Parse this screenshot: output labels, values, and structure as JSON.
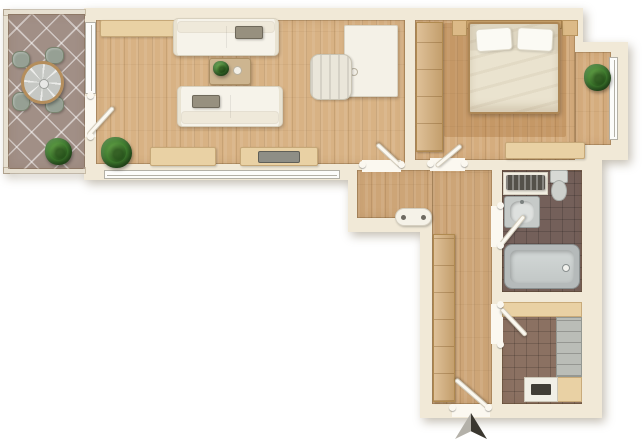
{
  "plan": {
    "width": 642,
    "height": 439,
    "background": "#ffffff"
  },
  "palette": {
    "wall": "#f1e9d7",
    "door_white": "#fbf8f0",
    "counter": "#e9d1a4",
    "wardrobe": "#d4ac76",
    "sofa": "#f6f3ea",
    "bed_duvet": "#eae3cf",
    "arrow_light": "#b4b1a9",
    "arrow_dark": "#3a372f"
  },
  "slabs": [
    {
      "name": "walls-main-block",
      "x": 84,
      "y": 8,
      "w": 499,
      "h": 172
    },
    {
      "name": "walls-bedroom-bay",
      "x": 583,
      "y": 42,
      "w": 45,
      "h": 118
    },
    {
      "name": "walls-hall-bath-block",
      "x": 348,
      "y": 160,
      "w": 254,
      "h": 72
    },
    {
      "name": "walls-lower-block",
      "x": 420,
      "y": 232,
      "w": 182,
      "h": 186
    }
  ],
  "railings": [
    {
      "name": "balcony-railing-left",
      "x": 4,
      "y": 10,
      "w": 5,
      "h": 163
    },
    {
      "name": "balcony-railing-top",
      "x": 4,
      "y": 10,
      "w": 81,
      "h": 5
    },
    {
      "name": "balcony-railing-bottom",
      "x": 4,
      "y": 168,
      "w": 81,
      "h": 5
    }
  ],
  "floors": [
    {
      "name": "balcony-floor",
      "kind": "tile-balcony",
      "color": "#a18f86",
      "x": 8,
      "y": 14,
      "w": 77,
      "h": 155
    },
    {
      "name": "living-room-floor",
      "kind": "wood",
      "color": "#d8b284",
      "x": 96,
      "y": 20,
      "w": 309,
      "h": 144
    },
    {
      "name": "bedroom-floor",
      "kind": "wood",
      "color": "#d5ad7e",
      "x": 415,
      "y": 20,
      "w": 160,
      "h": 140
    },
    {
      "name": "bedroom-bay-floor",
      "kind": "wood",
      "color": "#d5ad7e",
      "x": 575,
      "y": 52,
      "w": 36,
      "h": 93
    },
    {
      "name": "bedroom-rug",
      "kind": "rug",
      "color": "rgba(150,92,36,0.26)",
      "x": 444,
      "y": 23,
      "w": 122,
      "h": 114
    },
    {
      "name": "hall-floor-upper",
      "kind": "wood",
      "color": "#cda577",
      "x": 357,
      "y": 170,
      "w": 135,
      "h": 48
    },
    {
      "name": "hall-floor-lower",
      "kind": "wood",
      "color": "#cda577",
      "x": 432,
      "y": 170,
      "w": 60,
      "h": 234
    },
    {
      "name": "bathroom-floor",
      "kind": "tile-bath",
      "color": "#74605a",
      "x": 502,
      "y": 170,
      "w": 80,
      "h": 122
    },
    {
      "name": "kitchen-floor",
      "kind": "tile-kitchen",
      "color": "#8b7162",
      "x": 502,
      "y": 302,
      "w": 80,
      "h": 102
    }
  ],
  "gaps": [
    {
      "name": "balcony-door-opening",
      "x": 85,
      "y": 96,
      "w": 11,
      "h": 41
    },
    {
      "name": "living-door-threshold",
      "x": 362,
      "y": 160,
      "w": 39,
      "h": 12
    },
    {
      "name": "bedroom-door-threshold",
      "x": 430,
      "y": 158,
      "w": 35,
      "h": 13
    },
    {
      "name": "bathroom-door-opening",
      "x": 491,
      "y": 206,
      "w": 12,
      "h": 41
    },
    {
      "name": "kitchen-door-opening",
      "x": 491,
      "y": 304,
      "w": 12,
      "h": 40
    },
    {
      "name": "entrance-opening",
      "x": 452,
      "y": 404,
      "w": 38,
      "h": 13
    }
  ],
  "windows": [
    {
      "name": "balcony-window",
      "x": 85,
      "y": 22,
      "w": 11,
      "h": 72,
      "variant": "v"
    },
    {
      "name": "living-room-window",
      "x": 104,
      "y": 170,
      "w": 236,
      "h": 9,
      "variant": "h"
    },
    {
      "name": "bedroom-window",
      "x": 609,
      "y": 57,
      "w": 9,
      "h": 83,
      "variant": "v"
    }
  ],
  "door_leaves": [
    {
      "name": "balcony-door-leaf",
      "x": 88,
      "y": 133,
      "w": 38,
      "h": 5,
      "rot": -48
    },
    {
      "name": "living-door-leaf",
      "x": 401,
      "y": 164,
      "w": 33,
      "h": 5,
      "rot": -137
    },
    {
      "name": "bedroom-door-leaf",
      "x": 436,
      "y": 164,
      "w": 33,
      "h": 5,
      "rot": -40
    },
    {
      "name": "bathroom-door-leaf",
      "x": 501,
      "y": 242,
      "w": 37,
      "h": 5,
      "rot": -51
    },
    {
      "name": "kitchen-door-leaf",
      "x": 501,
      "y": 306,
      "w": 37,
      "h": 5,
      "rot": 47
    },
    {
      "name": "entrance-door-leaf",
      "x": 488,
      "y": 405,
      "w": 43,
      "h": 5,
      "rot": -139
    }
  ],
  "jamb_dots": [
    {
      "name": "jamb-dot",
      "x": 87,
      "y": 92,
      "w": 7,
      "h": 7
    },
    {
      "name": "jamb-dot",
      "x": 87,
      "y": 133,
      "w": 7,
      "h": 7
    },
    {
      "name": "jamb-dot",
      "x": 359,
      "y": 161,
      "w": 7,
      "h": 7
    },
    {
      "name": "jamb-dot",
      "x": 398,
      "y": 161,
      "w": 7,
      "h": 7
    },
    {
      "name": "jamb-dot",
      "x": 427,
      "y": 160,
      "w": 7,
      "h": 7
    },
    {
      "name": "jamb-dot",
      "x": 461,
      "y": 160,
      "w": 7,
      "h": 7
    },
    {
      "name": "jamb-dot",
      "x": 497,
      "y": 202,
      "w": 7,
      "h": 7
    },
    {
      "name": "jamb-dot",
      "x": 497,
      "y": 242,
      "w": 7,
      "h": 7
    },
    {
      "name": "jamb-dot",
      "x": 497,
      "y": 301,
      "w": 7,
      "h": 7
    },
    {
      "name": "jamb-dot",
      "x": 497,
      "y": 341,
      "w": 7,
      "h": 7
    },
    {
      "name": "jamb-dot",
      "x": 449,
      "y": 404,
      "w": 7,
      "h": 7
    },
    {
      "name": "jamb-dot",
      "x": 485,
      "y": 404,
      "w": 7,
      "h": 7
    }
  ],
  "furniture": [
    {
      "name": "patio-chair-1",
      "kind": "patio-chair",
      "x": 12,
      "y": 51,
      "w": 18,
      "h": 17
    },
    {
      "name": "patio-chair-2",
      "kind": "patio-chair",
      "x": 45,
      "y": 47,
      "w": 19,
      "h": 17
    },
    {
      "name": "patio-chair-3",
      "kind": "patio-chair",
      "x": 12,
      "y": 92,
      "w": 18,
      "h": 19
    },
    {
      "name": "patio-chair-4",
      "kind": "patio-chair",
      "x": 45,
      "y": 96,
      "w": 19,
      "h": 17
    },
    {
      "name": "patio-table",
      "kind": "round-table",
      "x": 21,
      "y": 61,
      "w": 43,
      "h": 43
    },
    {
      "name": "balcony-plant",
      "kind": "plant",
      "x": 45,
      "y": 138,
      "w": 27,
      "h": 27
    },
    {
      "name": "living-sideboard-top",
      "kind": "sideboard",
      "x": 100,
      "y": 20,
      "w": 88,
      "h": 17
    },
    {
      "name": "sofa-upper",
      "kind": "sofa",
      "variant": "back-top",
      "x": 173,
      "y": 18,
      "w": 106,
      "h": 38
    },
    {
      "name": "sofa-upper-tray",
      "kind": "tray",
      "x": 235,
      "y": 26,
      "w": 28,
      "h": 13
    },
    {
      "name": "coffee-table",
      "kind": "coffee-table",
      "x": 209,
      "y": 58,
      "w": 42,
      "h": 27
    },
    {
      "name": "coffee-table-plant",
      "kind": "plant",
      "x": 213,
      "y": 61,
      "w": 16,
      "h": 15
    },
    {
      "name": "coffee-table-dish",
      "kind": "deco-dot",
      "x": 233,
      "y": 66,
      "w": 9,
      "h": 9
    },
    {
      "name": "sofa-lower",
      "kind": "sofa",
      "variant": "back-bottom",
      "x": 177,
      "y": 86,
      "w": 106,
      "h": 41
    },
    {
      "name": "sofa-lower-tray",
      "kind": "tray",
      "x": 192,
      "y": 95,
      "w": 28,
      "h": 13
    },
    {
      "name": "desk",
      "kind": "desk",
      "x": 344,
      "y": 25,
      "w": 54,
      "h": 72
    },
    {
      "name": "desk-knob",
      "kind": "deco-dot",
      "x": 350,
      "y": 68,
      "w": 8,
      "h": 8
    },
    {
      "name": "desk-chair",
      "kind": "chair",
      "x": 310,
      "y": 54,
      "w": 42,
      "h": 46
    },
    {
      "name": "living-plant",
      "kind": "plant",
      "x": 101,
      "y": 137,
      "w": 31,
      "h": 31
    },
    {
      "name": "living-sideboard-left",
      "kind": "sideboard",
      "x": 150,
      "y": 147,
      "w": 66,
      "h": 19
    },
    {
      "name": "living-sideboard-right",
      "kind": "sideboard",
      "x": 240,
      "y": 147,
      "w": 78,
      "h": 19
    },
    {
      "name": "tv-on-sideboard",
      "kind": "tv",
      "x": 258,
      "y": 151,
      "w": 42,
      "h": 12
    },
    {
      "name": "bedroom-wardrobe",
      "kind": "wardrobe",
      "x": 416,
      "y": 22,
      "w": 27,
      "h": 130
    },
    {
      "name": "bed-headboard",
      "kind": "headboard",
      "x": 466,
      "y": 20,
      "w": 96,
      "h": 9
    },
    {
      "name": "nightstand-left",
      "kind": "nightstand",
      "x": 452,
      "y": 20,
      "w": 15,
      "h": 16
    },
    {
      "name": "nightstand-right",
      "kind": "nightstand",
      "x": 562,
      "y": 20,
      "w": 16,
      "h": 16
    },
    {
      "name": "double-bed",
      "kind": "bed",
      "x": 468,
      "y": 22,
      "w": 92,
      "h": 92
    },
    {
      "name": "bedroom-dresser",
      "kind": "sideboard",
      "x": 505,
      "y": 142,
      "w": 80,
      "h": 17
    },
    {
      "name": "bedroom-plant",
      "kind": "plant",
      "x": 584,
      "y": 64,
      "w": 27,
      "h": 27
    },
    {
      "name": "hall-bench",
      "kind": "bench",
      "x": 395,
      "y": 208,
      "w": 37,
      "h": 18
    },
    {
      "name": "hall-wardrobe",
      "kind": "wardrobe",
      "x": 433,
      "y": 234,
      "w": 22,
      "h": 168
    },
    {
      "name": "bath-shelf",
      "kind": "shelf",
      "x": 503,
      "y": 172,
      "w": 45,
      "h": 23
    },
    {
      "name": "bath-towel-radiator",
      "kind": "radiator",
      "x": 506,
      "y": 175,
      "w": 39,
      "h": 15
    },
    {
      "name": "bath-sink",
      "kind": "sink",
      "x": 504,
      "y": 196,
      "w": 36,
      "h": 32
    },
    {
      "name": "toilet",
      "kind": "toilet",
      "x": 549,
      "y": 170,
      "w": 20,
      "h": 32
    },
    {
      "name": "bathtub",
      "kind": "bathtub",
      "x": 504,
      "y": 244,
      "w": 76,
      "h": 45
    },
    {
      "name": "kitchen-counter-top",
      "kind": "counter",
      "x": 502,
      "y": 302,
      "w": 80,
      "h": 15
    },
    {
      "name": "fridge-shelves",
      "kind": "fridge",
      "x": 556,
      "y": 317,
      "w": 26,
      "h": 60
    },
    {
      "name": "kitchen-counter-right",
      "kind": "counter",
      "x": 556,
      "y": 377,
      "w": 26,
      "h": 25
    },
    {
      "name": "stove",
      "kind": "stove",
      "x": 524,
      "y": 377,
      "w": 34,
      "h": 25
    }
  ],
  "north_arrow": {
    "name": "north-arrow",
    "kind": "north-arrow",
    "x": 452,
    "y": 413,
    "w": 38,
    "h": 26
  }
}
